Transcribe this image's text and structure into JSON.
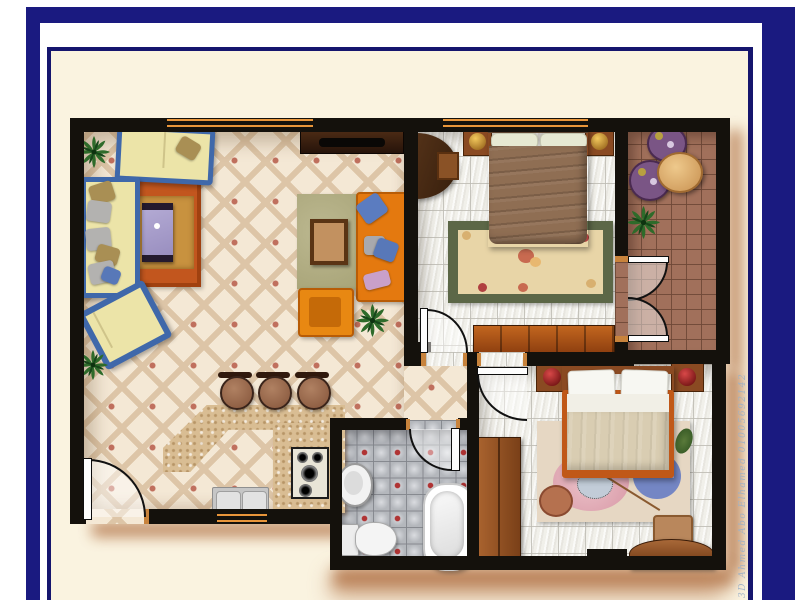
{
  "watermark": {
    "text": "3D Ahmed Abo Elhamed 01005692142"
  },
  "palette": {
    "frame_navy": "#1a1a80",
    "mat_cream": "#faf3e0",
    "wall_black": "#14110c",
    "shadow_brown": "#ad6a3c",
    "window_orange": "#e8953a",
    "living_floor": "#f4e8d5",
    "marble_floor": "#f1f0ea",
    "bath_floor": "#b4b7bc",
    "balcony_floor": "#a1705b"
  },
  "plan": {
    "rooms": [
      {
        "id": "living-room",
        "floor": "cream diamond-lattice tile with red accents"
      },
      {
        "id": "kitchen",
        "floor": "open plan, shares living room tile"
      },
      {
        "id": "hallway",
        "floor": "cream diamond-lattice tile"
      },
      {
        "id": "bedroom-1",
        "floor": "white marble tile"
      },
      {
        "id": "bedroom-2",
        "floor": "white marble tile"
      },
      {
        "id": "bathroom",
        "floor": "grey tile with red diamond accents"
      },
      {
        "id": "balcony",
        "floor": "terracotta tile grid"
      }
    ],
    "furniture": {
      "living_room": [
        "two-seat sofa (blue frame, yellow cushions)",
        "three-seat sofa (blue frame, yellow cushions)",
        "yellow chaise",
        "orange sofa",
        "orange armchair",
        "lavender coffee table on orange rug",
        "square wood table on olive rug",
        "tv cabinet",
        "3 potted plants"
      ],
      "kitchen": [
        "angled marble breakfast counter",
        "3 bar stools",
        "gas hob",
        "double sink"
      ],
      "bedroom_1": [
        "double bed with brown blanket",
        "2 nightstands with gold bowls",
        "floral rug",
        "long dresser",
        "semicircular desk with chair"
      ],
      "bedroom_2": [
        "double bed with beige blanket",
        "2 nightstands with red bowls",
        "abstract art rug",
        "wardrobe",
        "semicircular desk with chair"
      ],
      "bathroom": [
        "bathtub",
        "pedestal sink",
        "toilet"
      ],
      "balcony": [
        "round wood table",
        "2 purple chairs",
        "potted plant"
      ]
    },
    "doors": [
      "entry door (bottom-left)",
      "bedroom-1 door",
      "bedroom-2 door",
      "bathroom door",
      "balcony french doors"
    ],
    "windows": [
      "living-room window (top wall)",
      "bedroom-1 window (top wall)",
      "kitchen window (bottom wall)"
    ]
  }
}
